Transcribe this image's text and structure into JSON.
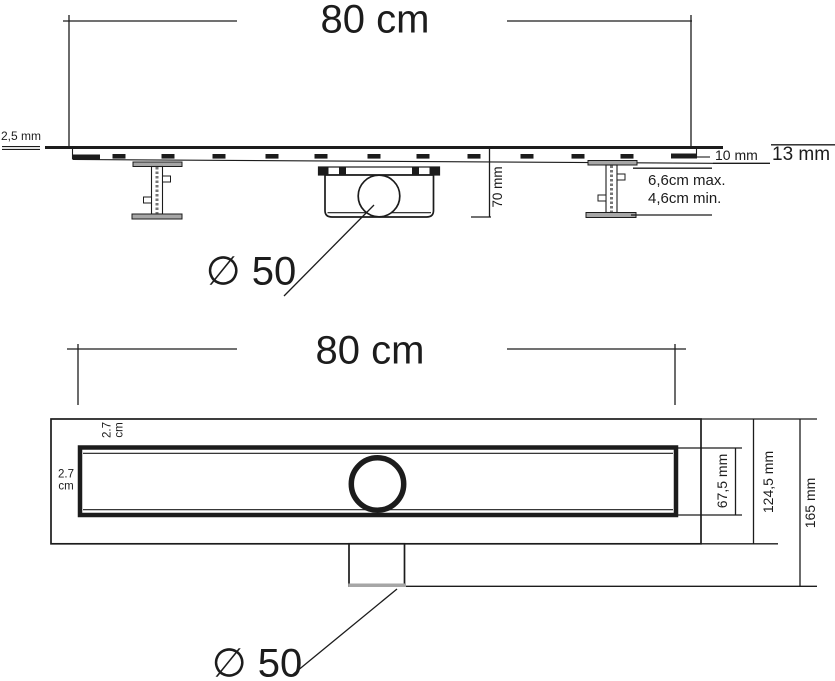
{
  "colors": {
    "ink": "#1c1c1c",
    "metal_gray": "#a6a6a6",
    "background": "#ffffff"
  },
  "side_view": {
    "width_label": "80 cm",
    "grate_thickness_label": "2,5 mm",
    "trap_height_label": "70 mm",
    "tile_level_inner_label": "10 mm",
    "tile_level_outer_label": "13 mm",
    "feet_max_label": "6,6cm max.",
    "feet_min_label": "4,6cm min.",
    "outlet_diameter_label": "∅ 50"
  },
  "plan_view": {
    "width_label": "80 cm",
    "top_edge_offset": {
      "value": "2.7",
      "unit": "cm"
    },
    "left_edge_offset": {
      "value": "2.7",
      "unit": "cm"
    },
    "channel_width_label": "67,5 mm",
    "body_width_label": "124,5 mm",
    "overall_width_label": "165 mm",
    "outlet_diameter_label": "∅ 50"
  }
}
